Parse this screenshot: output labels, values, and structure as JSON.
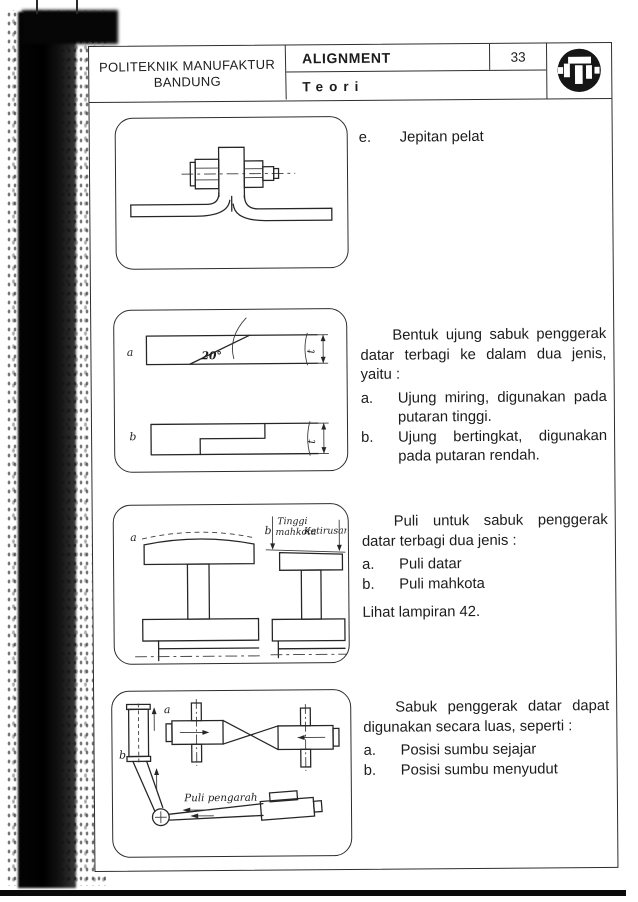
{
  "header": {
    "institution_line1": "POLITEKNIK MANUFAKTUR",
    "institution_line2": "BANDUNG",
    "title": "ALIGNMENT",
    "subtitle": "Teori",
    "page_number": "33"
  },
  "section_plate_clamp": {
    "item_label": "e.",
    "item_text": "Jepitan pelat"
  },
  "section_belt_ends": {
    "paragraph": "Bentuk ujung sabuk penggerak datar terbagi ke dalam dua jenis, yaitu :",
    "items": [
      {
        "label": "a.",
        "text": "Ujung miring, digunakan pada putaran tinggi."
      },
      {
        "label": "b.",
        "text": "Ujung bertingkat, digunakan pada putaran rendah."
      }
    ],
    "figure": {
      "label_a": "a",
      "label_b": "b",
      "angle": "20°",
      "thickness": "t"
    }
  },
  "section_pulleys": {
    "paragraph": "Puli untuk sabuk penggerak datar terbagi dua jenis :",
    "items": [
      {
        "label": "a.",
        "text": "Puli datar"
      },
      {
        "label": "b.",
        "text": "Puli mahkota"
      }
    ],
    "note": "Lihat lampiran 42.",
    "figure": {
      "label_a": "a",
      "label_b": "b",
      "crown_height_line1": "Tinggi",
      "crown_height_line2": "mahkota",
      "taper": "Ketirusan"
    }
  },
  "section_belt_usage": {
    "paragraph": "Sabuk penggerak datar dapat digunakan secara luas, seperti :",
    "items": [
      {
        "label": "a.",
        "text": "Posisi sumbu sejajar"
      },
      {
        "label": "b.",
        "text": "Posisi sumbu menyudut"
      }
    ],
    "figure": {
      "label_a": "a",
      "label_b": "b",
      "guide_pulley": "Puli pengarah"
    }
  },
  "colors": {
    "ink": "#1c1c1c",
    "paper": "#ffffff",
    "scan_band": "#000000"
  }
}
